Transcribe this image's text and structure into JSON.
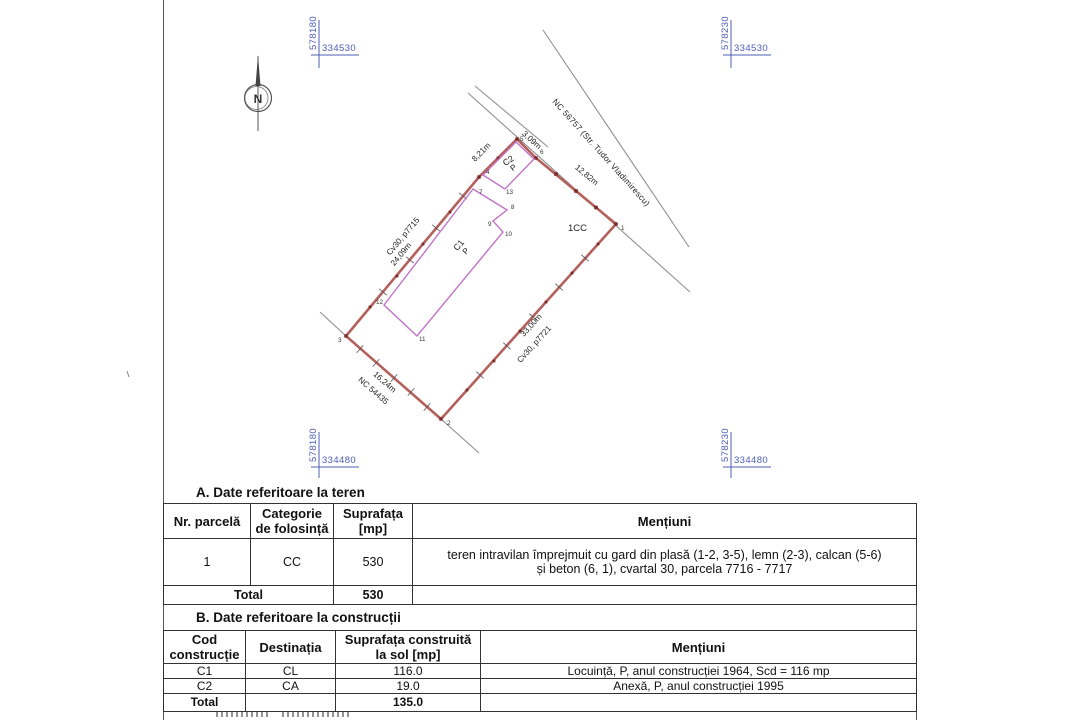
{
  "titles": {
    "section_a": "A. Date referitoare la teren",
    "section_b": "B. Date referitoare la construcții"
  },
  "coords": {
    "tl_e": "578180",
    "tl_n": "334530",
    "tr_e": "578230",
    "tr_n": "334530",
    "bl_e": "578180",
    "bl_n": "334480",
    "br_e": "578230",
    "br_n": "334480"
  },
  "plan": {
    "north_label": "N",
    "road_label": "NC 56757 (Str. Tudor Vladimirescu)",
    "zone_label": "1CC",
    "dim_top": "3,09m",
    "dim_ne": "12,82m",
    "dim_nw_upper": "8,21m",
    "dim_nw": "24,09m",
    "neighbor_nw": "Cv30, p7715",
    "dim_se": "33,00m",
    "neighbor_se": "Cv30, p7721",
    "dim_sw": "16,24m",
    "neighbor_sw": "NC 54435",
    "c1_label": "C1",
    "c1_regime": "P",
    "c2_label": "C2",
    "c2_regime": "P",
    "points": {
      "p1": "1",
      "p2": "2",
      "p3": "3",
      "p4": "4",
      "p5": "5",
      "p6": "6",
      "p7": "7",
      "p8": "8",
      "p9": "9",
      "p10": "10",
      "p11": "11",
      "p12": "12",
      "p13": "13"
    }
  },
  "table_a": {
    "h_nr": "Nr. parcelă",
    "h_cat1": "Categorie",
    "h_cat2": "de folosință",
    "h_sup1": "Suprafața",
    "h_sup2": "[mp]",
    "h_men": "Mențiuni",
    "row": {
      "nr": "1",
      "cat": "CC",
      "sup": "530",
      "men1": "teren intravilan împrejmuit cu gard din plasă (1-2, 3-5), lemn (2-3), calcan (5-6)",
      "men2": "și beton (6, 1), cvartal 30, parcela 7716 - 7717"
    },
    "total_label": "Total",
    "total_value": "530"
  },
  "table_b": {
    "h_cod1": "Cod",
    "h_cod2": "construcție",
    "h_dest": "Destinația",
    "h_sup1": "Suprafața construită",
    "h_sup2": "la sol [mp]",
    "h_men": "Mențiuni",
    "rows": [
      {
        "cod": "C1",
        "dest": "CL",
        "sup": "116.0",
        "men": "Locuință, P, anul construcției 1964, Scd = 116 mp"
      },
      {
        "cod": "C2",
        "dest": "CA",
        "sup": "19.0",
        "men": "Anexă, P, anul construcției 1995"
      }
    ],
    "total_label": "Total",
    "total_value": "135.0"
  },
  "colors": {
    "boundary_red": "#b4605c",
    "marker_dark_red": "#7c2d2a",
    "building_magenta": "#c273c8",
    "road_gray": "#8f8f8f",
    "coord_blue": "#4c5cb6"
  }
}
